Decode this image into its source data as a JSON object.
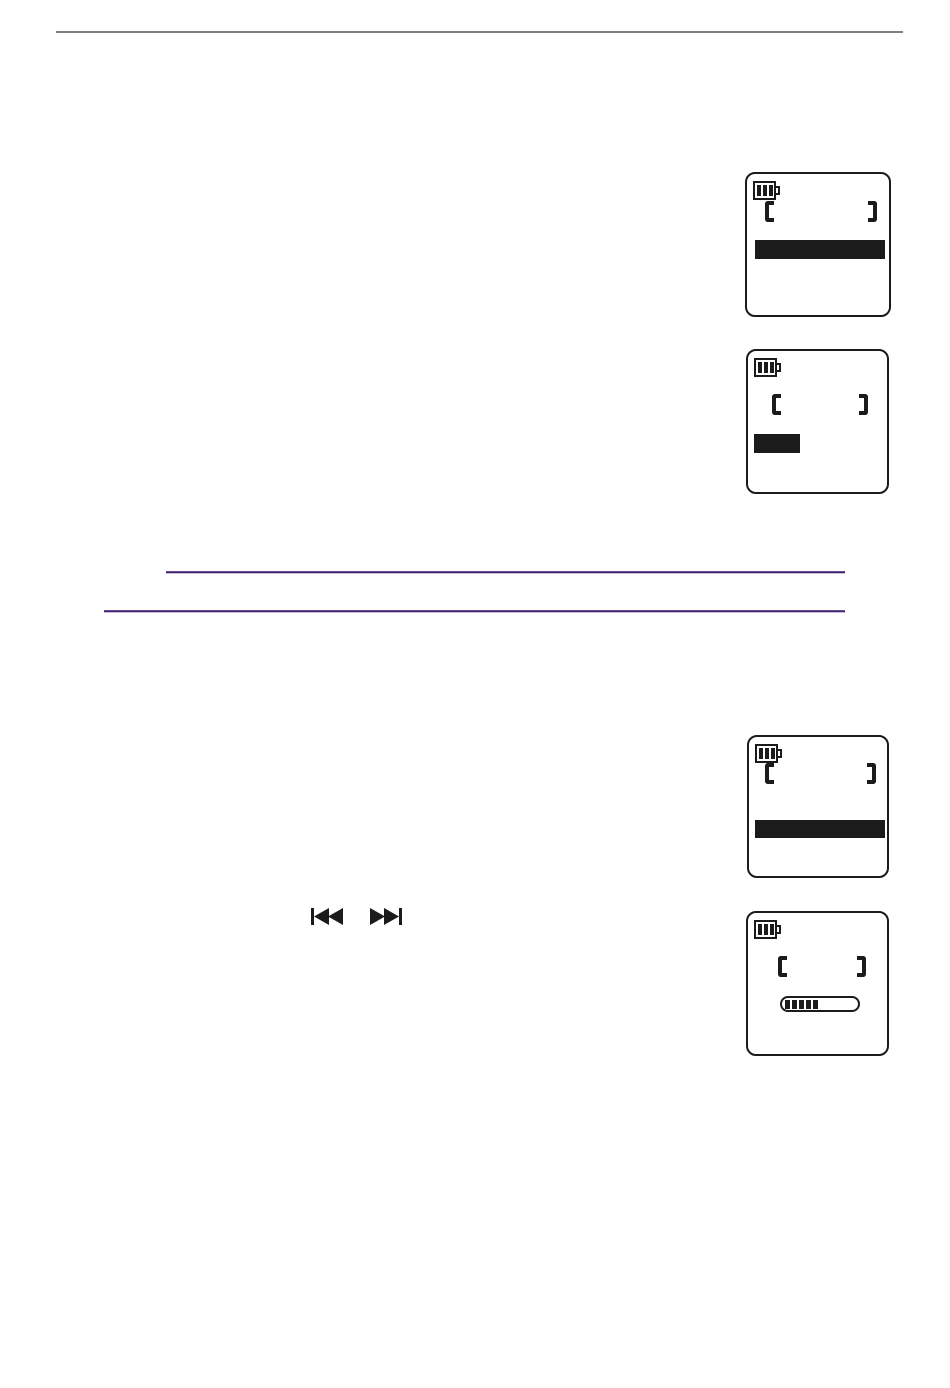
{
  "colors": {
    "ink": "#1b1b1b",
    "rule_gray": "#7f7f7f",
    "divider_top": "#6a4c9f",
    "divider_mid": "#3f2566",
    "divider_bottom": "#c9bce0",
    "page_bg": "#ffffff"
  },
  "page": {
    "kind": "manual-page-illustrations-only",
    "visible_text": ""
  },
  "header": {
    "rule": "gray-horizontal-rule"
  },
  "dividers": [
    {
      "name": "purple-divider-upper"
    },
    {
      "name": "purple-divider-lower"
    }
  ],
  "transport_icons": [
    {
      "name": "skip-back-icon"
    },
    {
      "name": "skip-forward-icon"
    }
  ],
  "lcd_common": {
    "battery_bars": 3
  },
  "lcd_screens": [
    {
      "name": "lcd-menu-full-row-selected",
      "elements": [
        "battery-icon",
        "bracket-frame",
        "selected-row-bar-full-width"
      ]
    },
    {
      "name": "lcd-menu-short-item-selected",
      "elements": [
        "battery-icon",
        "bracket-frame",
        "selected-item-bar-short"
      ]
    },
    {
      "name": "lcd-menu-full-row-selected",
      "elements": [
        "battery-icon",
        "bracket-frame",
        "selected-row-bar-full-width"
      ]
    },
    {
      "name": "lcd-level-meter",
      "elements": [
        "battery-icon",
        "bracket-frame",
        "segmented-meter"
      ],
      "meter": {
        "segments_filled": 5
      }
    }
  ]
}
